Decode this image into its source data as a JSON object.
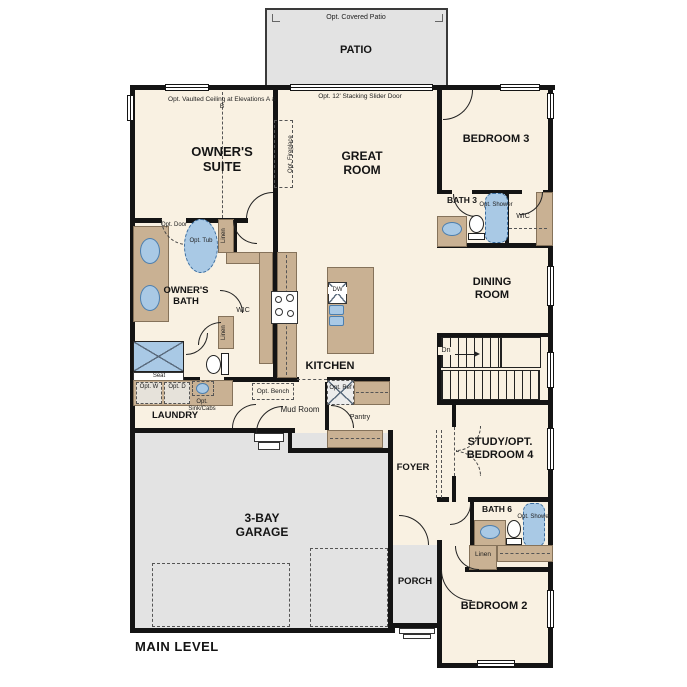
{
  "level": "MAIN LEVEL",
  "rooms": {
    "patio": "PATIO",
    "owners_suite": "OWNER'S SUITE",
    "great_room": "GREAT ROOM",
    "bedroom3": "BEDROOM 3",
    "bath3": "BATH 3",
    "dining_room": "DINING ROOM",
    "owners_bath": "OWNER'S BATH",
    "kitchen": "KITCHEN",
    "laundry": "LAUNDRY",
    "mud_room": "Mud Room",
    "pantry": "Pantry",
    "foyer": "FOYER",
    "study": "STUDY/OPT. BEDROOM 4",
    "bath6": "BATH 6",
    "bedroom2": "BEDROOM 2",
    "porch": "PORCH",
    "garage": "3-BAY GARAGE",
    "wic": "WIC",
    "linen": "Linen"
  },
  "ann": {
    "covered_patio": "Opt. Covered Patio",
    "slider": "Opt. 12' Stacking Slider Door",
    "vaulted": "Opt. Vaulted Ceiling at Elevations A & B",
    "fireplace": "Opt. Fireplace",
    "opt_door": "Opt. Door",
    "opt_tub": "Opt. Tub",
    "seat": "Seat",
    "opt_w": "Opt. W",
    "opt_d": "Opt. D",
    "opt_sink_cabs": "Opt. Sink/Cabs",
    "opt_bench": "Opt. Bench",
    "opt_ref": "Opt. Ref",
    "opt_shower": "Opt. Shower",
    "dn": "Dn",
    "dw": "DW"
  },
  "colors": {
    "wall": "#141414",
    "floor": "#f9f1e2",
    "fixture_blue": "#a9c9e5",
    "cabinet_tan": "#c9b193",
    "exterior_gray": "#e3e3e3"
  }
}
